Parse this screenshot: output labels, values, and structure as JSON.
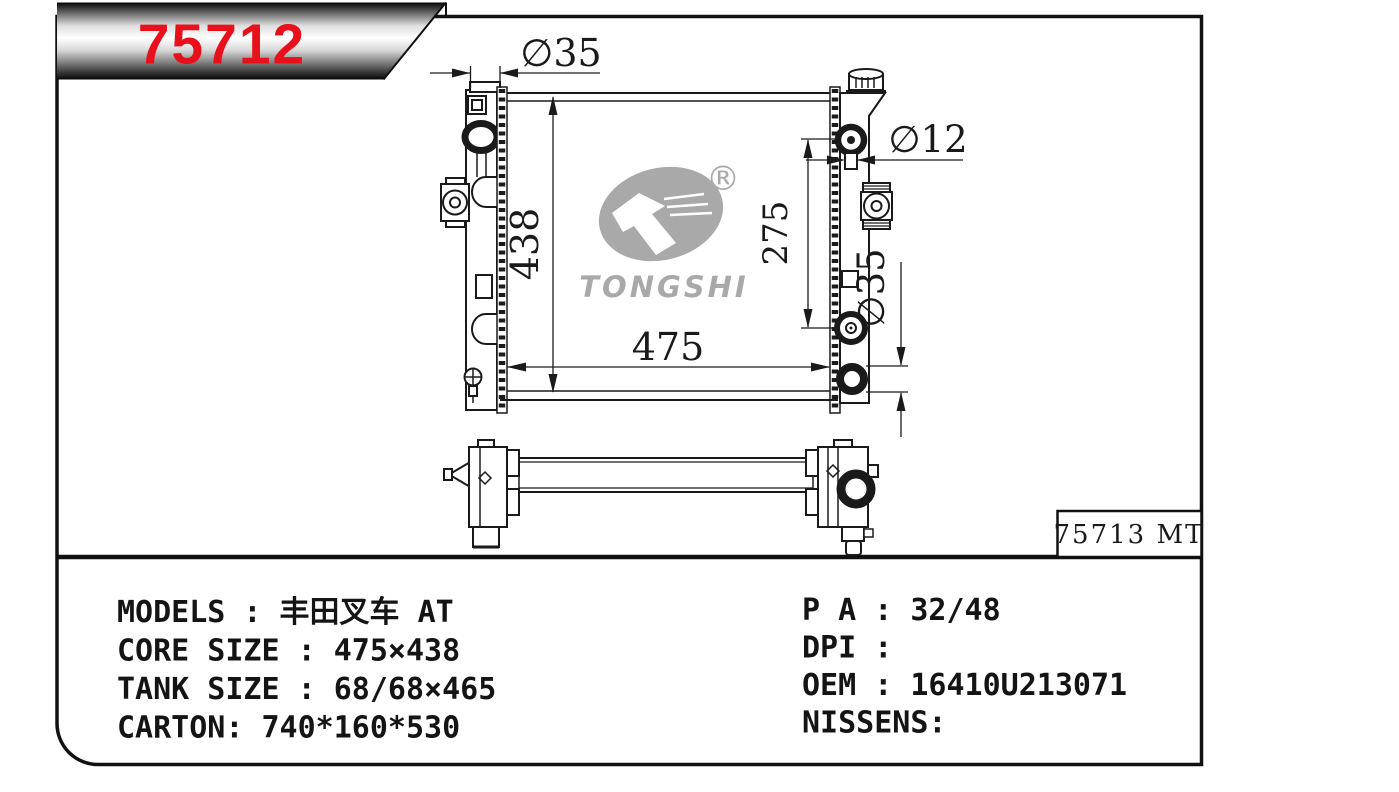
{
  "banner": {
    "part_number": "75712"
  },
  "colors": {
    "accent_red": "#e8101b",
    "line": "#1a1a1a",
    "logo_gray": "#a9a9a9"
  },
  "watermark": {
    "brand": "TONGSHI",
    "registered": "®"
  },
  "drawing": {
    "label_box": "75713 MT",
    "dimensions": {
      "inlet_diameter": "∅35",
      "core_height": "438",
      "core_width": "475",
      "pipe_spacing": "275",
      "small_pipe_diameter": "∅12",
      "outlet_diameter": "∅35"
    }
  },
  "specs": {
    "left": [
      "MODELS : 丰田叉车 AT",
      "CORE SIZE : 475×438",
      "TANK SIZE : 68/68×465",
      "CARTON: 740*160*530"
    ],
    "right": [
      "P A : 32/48",
      "DPI :",
      "OEM : 16410U213071",
      "NISSENS:"
    ]
  }
}
